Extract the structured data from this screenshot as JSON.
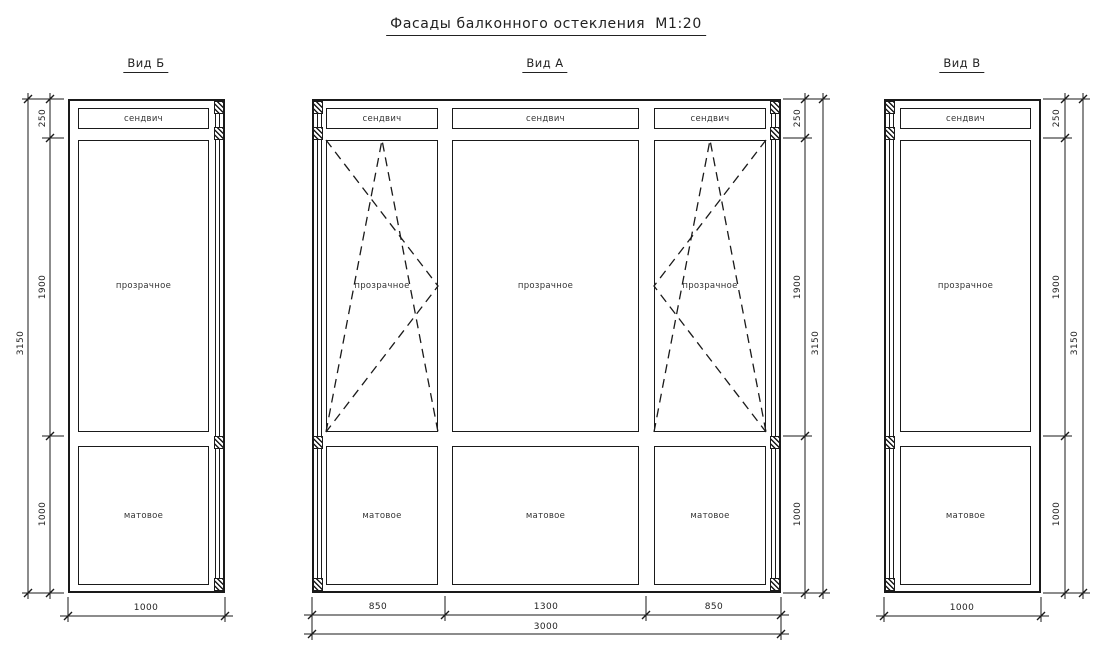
{
  "title": "Фасады балконного остекления  М1:20",
  "views": {
    "b": {
      "label": "Вид Б",
      "panels": {
        "sandwich": "сендвич",
        "transparent": "прозрачное",
        "matte": "матовое"
      },
      "dims": {
        "top": "250",
        "middle": "1900",
        "bottom": "1000",
        "total_height": "3150",
        "width": "1000"
      }
    },
    "a": {
      "label": "Вид А",
      "columns": {
        "left": {
          "sandwich": "сендвич",
          "glass": "прозрачное",
          "matte": "матовое"
        },
        "center": {
          "sandwich": "сендвич",
          "glass": "прозрачное",
          "matte": "матовое"
        },
        "right": {
          "sandwich": "сендвич",
          "glass": "прозрачное",
          "matte": "матовое"
        }
      },
      "dims": {
        "top": "250",
        "middle": "1900",
        "bottom": "1000",
        "total_height": "3150",
        "col_left": "850",
        "col_center": "1300",
        "col_right": "850",
        "total_width": "3000"
      }
    },
    "v": {
      "label": "Вид В",
      "panels": {
        "sandwich": "сендвич",
        "transparent": "прозрачное",
        "matte": "матовое"
      },
      "dims": {
        "top": "250",
        "middle": "1900",
        "bottom": "1000",
        "total_height": "3150",
        "width": "1000"
      }
    }
  },
  "colors": {
    "line": "#1a1a1a",
    "background": "#ffffff"
  }
}
